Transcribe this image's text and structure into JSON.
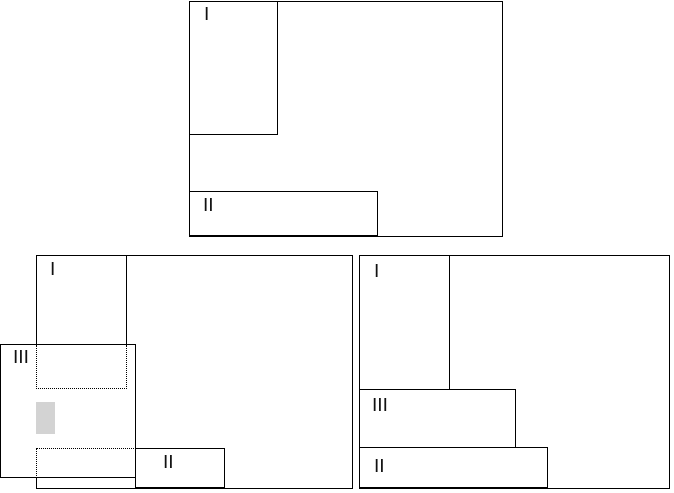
{
  "figure": {
    "colors": {
      "stroke": "#000000",
      "background": "#ffffff",
      "highlight_fill": "#d3d3d3"
    },
    "panels": [
      {
        "id": "top",
        "regions": [
          {
            "label": "I"
          },
          {
            "label": "II"
          }
        ]
      },
      {
        "id": "bottom-left",
        "regions": [
          {
            "label": "I"
          },
          {
            "label": "III"
          },
          {
            "label": "II"
          }
        ],
        "extras": [
          "dotted-outline-upper",
          "gray-highlight-block",
          "dotted-outline-lower"
        ]
      },
      {
        "id": "bottom-right",
        "regions": [
          {
            "label": "I"
          },
          {
            "label": "III"
          },
          {
            "label": "II"
          }
        ]
      }
    ]
  }
}
